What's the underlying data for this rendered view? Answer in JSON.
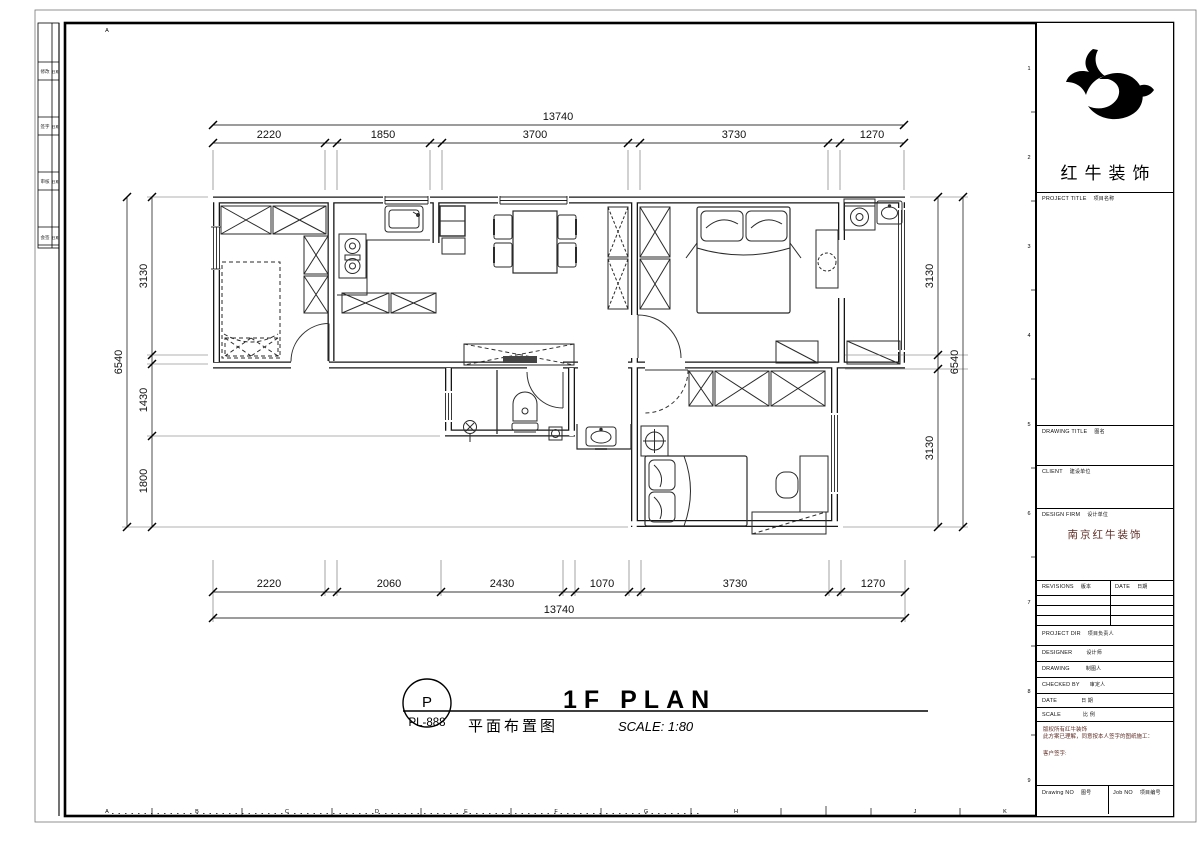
{
  "sheet": {
    "corner_letter": "A",
    "col_letters": [
      "A",
      "B",
      "C",
      "D",
      "E",
      "F",
      "G",
      "H",
      "J",
      "K"
    ],
    "row_numbers": [
      "1",
      "2",
      "3",
      "4",
      "5",
      "6",
      "7",
      "8",
      "9"
    ]
  },
  "fold_strip": {
    "rows": [
      {
        "left": "修改",
        "right": "日期"
      },
      {
        "left": "签字",
        "right": "日期"
      },
      {
        "left": "审核",
        "right": "日期"
      },
      {
        "left": "会签",
        "right": "日期"
      }
    ]
  },
  "dims": {
    "top": {
      "overall": "13740",
      "segments": [
        "2220",
        "1850",
        "3700",
        "3730",
        "1270"
      ]
    },
    "bottom": {
      "overall": "13740",
      "segments": [
        "2220",
        "2060",
        "2430",
        "1070",
        "3730",
        "1270"
      ]
    },
    "left": {
      "overall": "6540",
      "segments": [
        "3130",
        "1430",
        "1800"
      ]
    },
    "right": {
      "overall": "6540",
      "segments": [
        "3130",
        "3130"
      ]
    }
  },
  "plan_title": {
    "bubble_letter": "P",
    "bubble_code": "PL-888",
    "title_en": "1F PLAN",
    "title_cn": "平面布置图",
    "scale": "SCALE: 1:80"
  },
  "title_block": {
    "brand": "红牛装饰",
    "project_title": {
      "en": "PROJECT TITLE",
      "cn": "项目名称"
    },
    "drawing_title": {
      "en": "DRAWING TITLE",
      "cn": "图名"
    },
    "client": {
      "en": "CLIENT",
      "cn": "建设单位"
    },
    "design_firm": {
      "en": "DESIGN FIRM",
      "cn": "设计单位"
    },
    "design_firm_name": "南京红牛装饰",
    "revisions": {
      "en": "REVISIONS",
      "cn": "版本"
    },
    "rev_date": {
      "en": "DATE",
      "cn": "日期"
    },
    "project_dir": {
      "en": "PROJECT DIR",
      "cn": "项目负责人"
    },
    "designer": {
      "en": "DESIGNER",
      "cn": "设计师"
    },
    "drawing": {
      "en": "DRAWING",
      "cn": "制图人"
    },
    "checked_by": {
      "en": "CHECKED BY",
      "cn": "审定人"
    },
    "date": {
      "en": "DATE",
      "cn": "日 期"
    },
    "scale": {
      "en": "SCALE",
      "cn": "比 例"
    },
    "disclaimer_line1": "版权所有红牛装饰",
    "disclaimer_line2": "此方案已理解，同意按本人签字的图纸施工：",
    "client_sign": "客户签字:",
    "drawing_no": {
      "en": "Drawing NO",
      "cn": "图号"
    },
    "job_no": {
      "en": "Job NO",
      "cn": "项目编号"
    }
  }
}
